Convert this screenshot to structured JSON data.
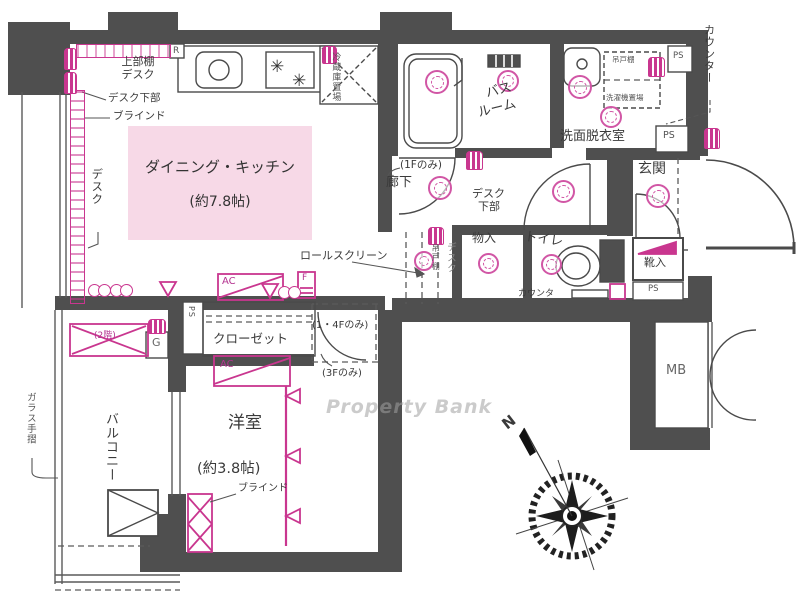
{
  "watermark": "Property Bank",
  "compass": {
    "north": "N"
  },
  "rooms": {
    "dining": {
      "name": "ダイニング・キッチン",
      "size": "(約7.8帖)"
    },
    "western": {
      "name": "洋室",
      "size": "(約3.8帖)"
    },
    "balcony": {
      "name": "バルコニー"
    },
    "bathroom": {
      "line1": "バス",
      "line2": "ルーム"
    },
    "washroom": {
      "name": "洗面脱衣室"
    },
    "hallway": {
      "name": "廊下"
    },
    "entrance": {
      "name": "玄関"
    },
    "toilet": {
      "name": "トイレ"
    },
    "storage": {
      "name": "物入"
    },
    "closet": {
      "name": "クローゼット"
    },
    "shoe_cabinet": {
      "name": "靴入"
    },
    "meter_box": {
      "name": "MB"
    }
  },
  "fixtures": {
    "fridge_space": "冷蔵庫置場",
    "hanging_cupboard": "吊戸棚",
    "washer_space": "洗濯機置場",
    "roll_screen": "ロールスクリーン",
    "outdoor_unit": "(2階)",
    "counter": "カウンター",
    "counter_small": "カウンタ",
    "glass_rail": "ガラス手摺"
  },
  "annotations": {
    "upper_shelf": "上部棚",
    "desk": "デスク",
    "desk_lower": "デスク下部",
    "desk_line2": "下部",
    "blind": "ブラインド",
    "floor1_only": "(1Fのみ)",
    "floor14_only": "(1・4Fのみ)",
    "floor3_only": "(3Fのみ)"
  },
  "badges": {
    "ps": "PS",
    "ac": "AC",
    "r": "R",
    "g": "G",
    "f": "F"
  }
}
